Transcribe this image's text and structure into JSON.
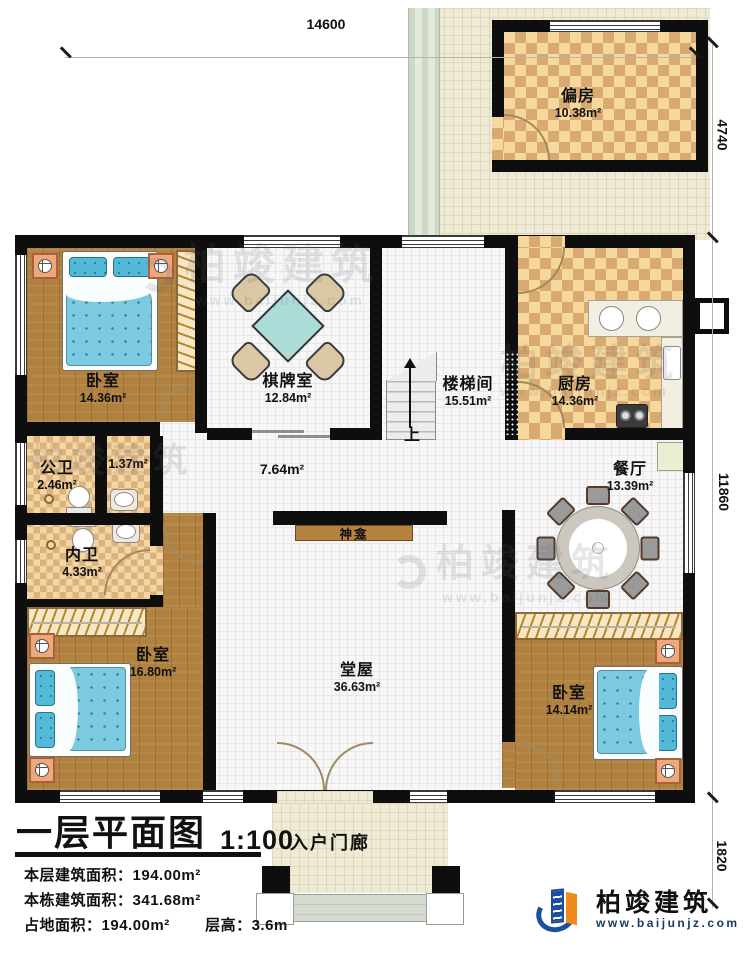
{
  "title": {
    "name": "一层平面图",
    "scale": "1:100"
  },
  "stats": [
    {
      "label": "本层建筑面积：",
      "value": "194.00m²"
    },
    {
      "label": "本栋建筑面积：",
      "value": "341.68m²"
    },
    {
      "label": "占地面积：",
      "value": "194.00m²"
    },
    {
      "label": "层高：",
      "value": "3.6m"
    }
  ],
  "dimensions": {
    "top": "14600",
    "right": [
      "4740",
      "11860",
      "1820"
    ]
  },
  "rooms": [
    {
      "id": "pianfang",
      "name": "偏房",
      "area": "10.38m²"
    },
    {
      "id": "bedroom1",
      "name": "卧室",
      "area": "14.36m²"
    },
    {
      "id": "qipaishi",
      "name": "棋牌室",
      "area": "12.84m²"
    },
    {
      "id": "loutijian",
      "name": "楼梯间",
      "area": "15.51m²"
    },
    {
      "id": "kitchen",
      "name": "厨房",
      "area": "14.36m²"
    },
    {
      "id": "gongwei",
      "name": "公卫",
      "area": "2.46m²"
    },
    {
      "id": "nook",
      "name": "",
      "area": "1.37m²"
    },
    {
      "id": "hallway",
      "name": "",
      "area": "7.64m²"
    },
    {
      "id": "neiwei",
      "name": "内卫",
      "area": "4.33m²"
    },
    {
      "id": "dining",
      "name": "餐厅",
      "area": "13.39m²"
    },
    {
      "id": "bedroom2",
      "name": "卧室",
      "area": "16.80m²"
    },
    {
      "id": "tangwu",
      "name": "堂屋",
      "area": "36.63m²"
    },
    {
      "id": "bedroom3",
      "name": "卧室",
      "area": "14.14m²"
    },
    {
      "id": "porch",
      "name": "入户门廊",
      "area": ""
    }
  ],
  "annotations": {
    "shrine": "神龛",
    "stairs_up": "上"
  },
  "branding": {
    "company": "柏竣建筑",
    "website": "www.baijunjz.com"
  },
  "colors": {
    "wall": "#0e0e0e",
    "wood_floor": "#b0813f",
    "checker_light": "#f7d89c",
    "checker_dark": "#d8a971",
    "tile": "#eeead5",
    "bed": "#7ccadf",
    "logo_blue": "#1c4f9c",
    "logo_orange": "#ef8a1c"
  }
}
